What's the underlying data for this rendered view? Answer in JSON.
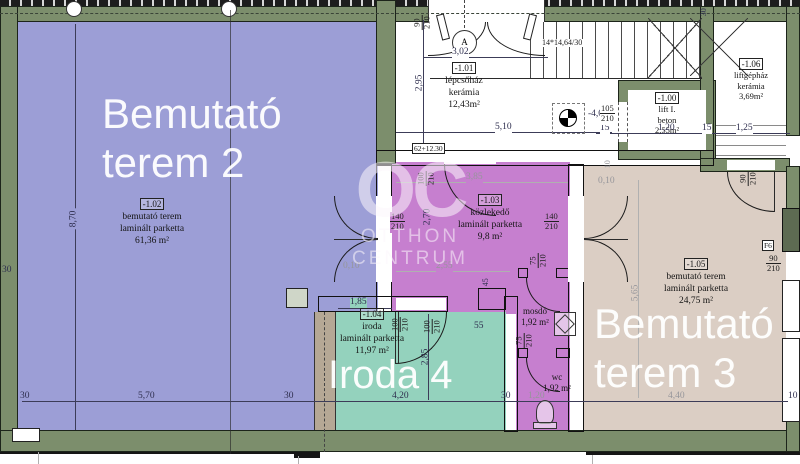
{
  "watermark": {
    "monogram": "OC",
    "line1": "OTTHON",
    "line2": "CENTRUM"
  },
  "rooms": [
    {
      "code": "-1.02",
      "name": "bemutató terem",
      "floor": "laminált parketta",
      "area": "61,36 m²",
      "big1": "Bemutató",
      "big2": "terem 2"
    },
    {
      "code": "-1.01",
      "name": "lépcsőház",
      "floor": "kerámia",
      "area": "12,43m²"
    },
    {
      "code": "-1.00",
      "name": "lift I.",
      "floor": "beton",
      "area": "2,55m²"
    },
    {
      "code": "-1.06",
      "name": "liftgépház",
      "floor": "kerámia",
      "area": "3,69m²"
    },
    {
      "code": "-1.03",
      "name": "közlekedő",
      "floor": "laminált parketta",
      "area": "9,8 m²"
    },
    {
      "code": "-1.04",
      "name": "iroda",
      "floor": "laminált parketta",
      "area": "11,97 m²",
      "big1": "Iroda 4"
    },
    {
      "code": "-1.05",
      "name": "bemutató terem",
      "floor": "laminált parketta",
      "area": "24,75 m²",
      "big1": "Bemutató",
      "big2": "terem 3"
    },
    {
      "name": "mosdó",
      "area": "1,92 m²"
    },
    {
      "name": "wc",
      "area": "1,92 m²"
    }
  ],
  "dims": {
    "t30": "30",
    "w570": "5,70",
    "h870": "8,70",
    "w302": "3,02",
    "h295": "2,95",
    "w510": "5,10",
    "stairs": "14*14,64/30",
    "level": "-4,00",
    "step": "62+12.30",
    "n90": "90",
    "n100": "100",
    "n105": "105",
    "n140": "140",
    "n75": "75",
    "n210": "210",
    "n15": "15",
    "w120": "1,20",
    "w125": "1,25",
    "w385": "3,85",
    "h270": "2,70",
    "w255": "2,55",
    "g010": "0,10",
    "n45": "45",
    "n10": "10",
    "w185": "1,85",
    "h285": "2,85",
    "w420": "4,20",
    "n55": "55",
    "h565": "5,65",
    "w440": "4,40"
  },
  "markers": {
    "axis": "A",
    "f6": "F6"
  },
  "colors": {
    "wall": "#7c8e6c",
    "room_purple": "#9c9ed6",
    "room_pink": "#c67fcf",
    "room_green": "#94d2bd",
    "room_beige": "#dbcec4"
  }
}
